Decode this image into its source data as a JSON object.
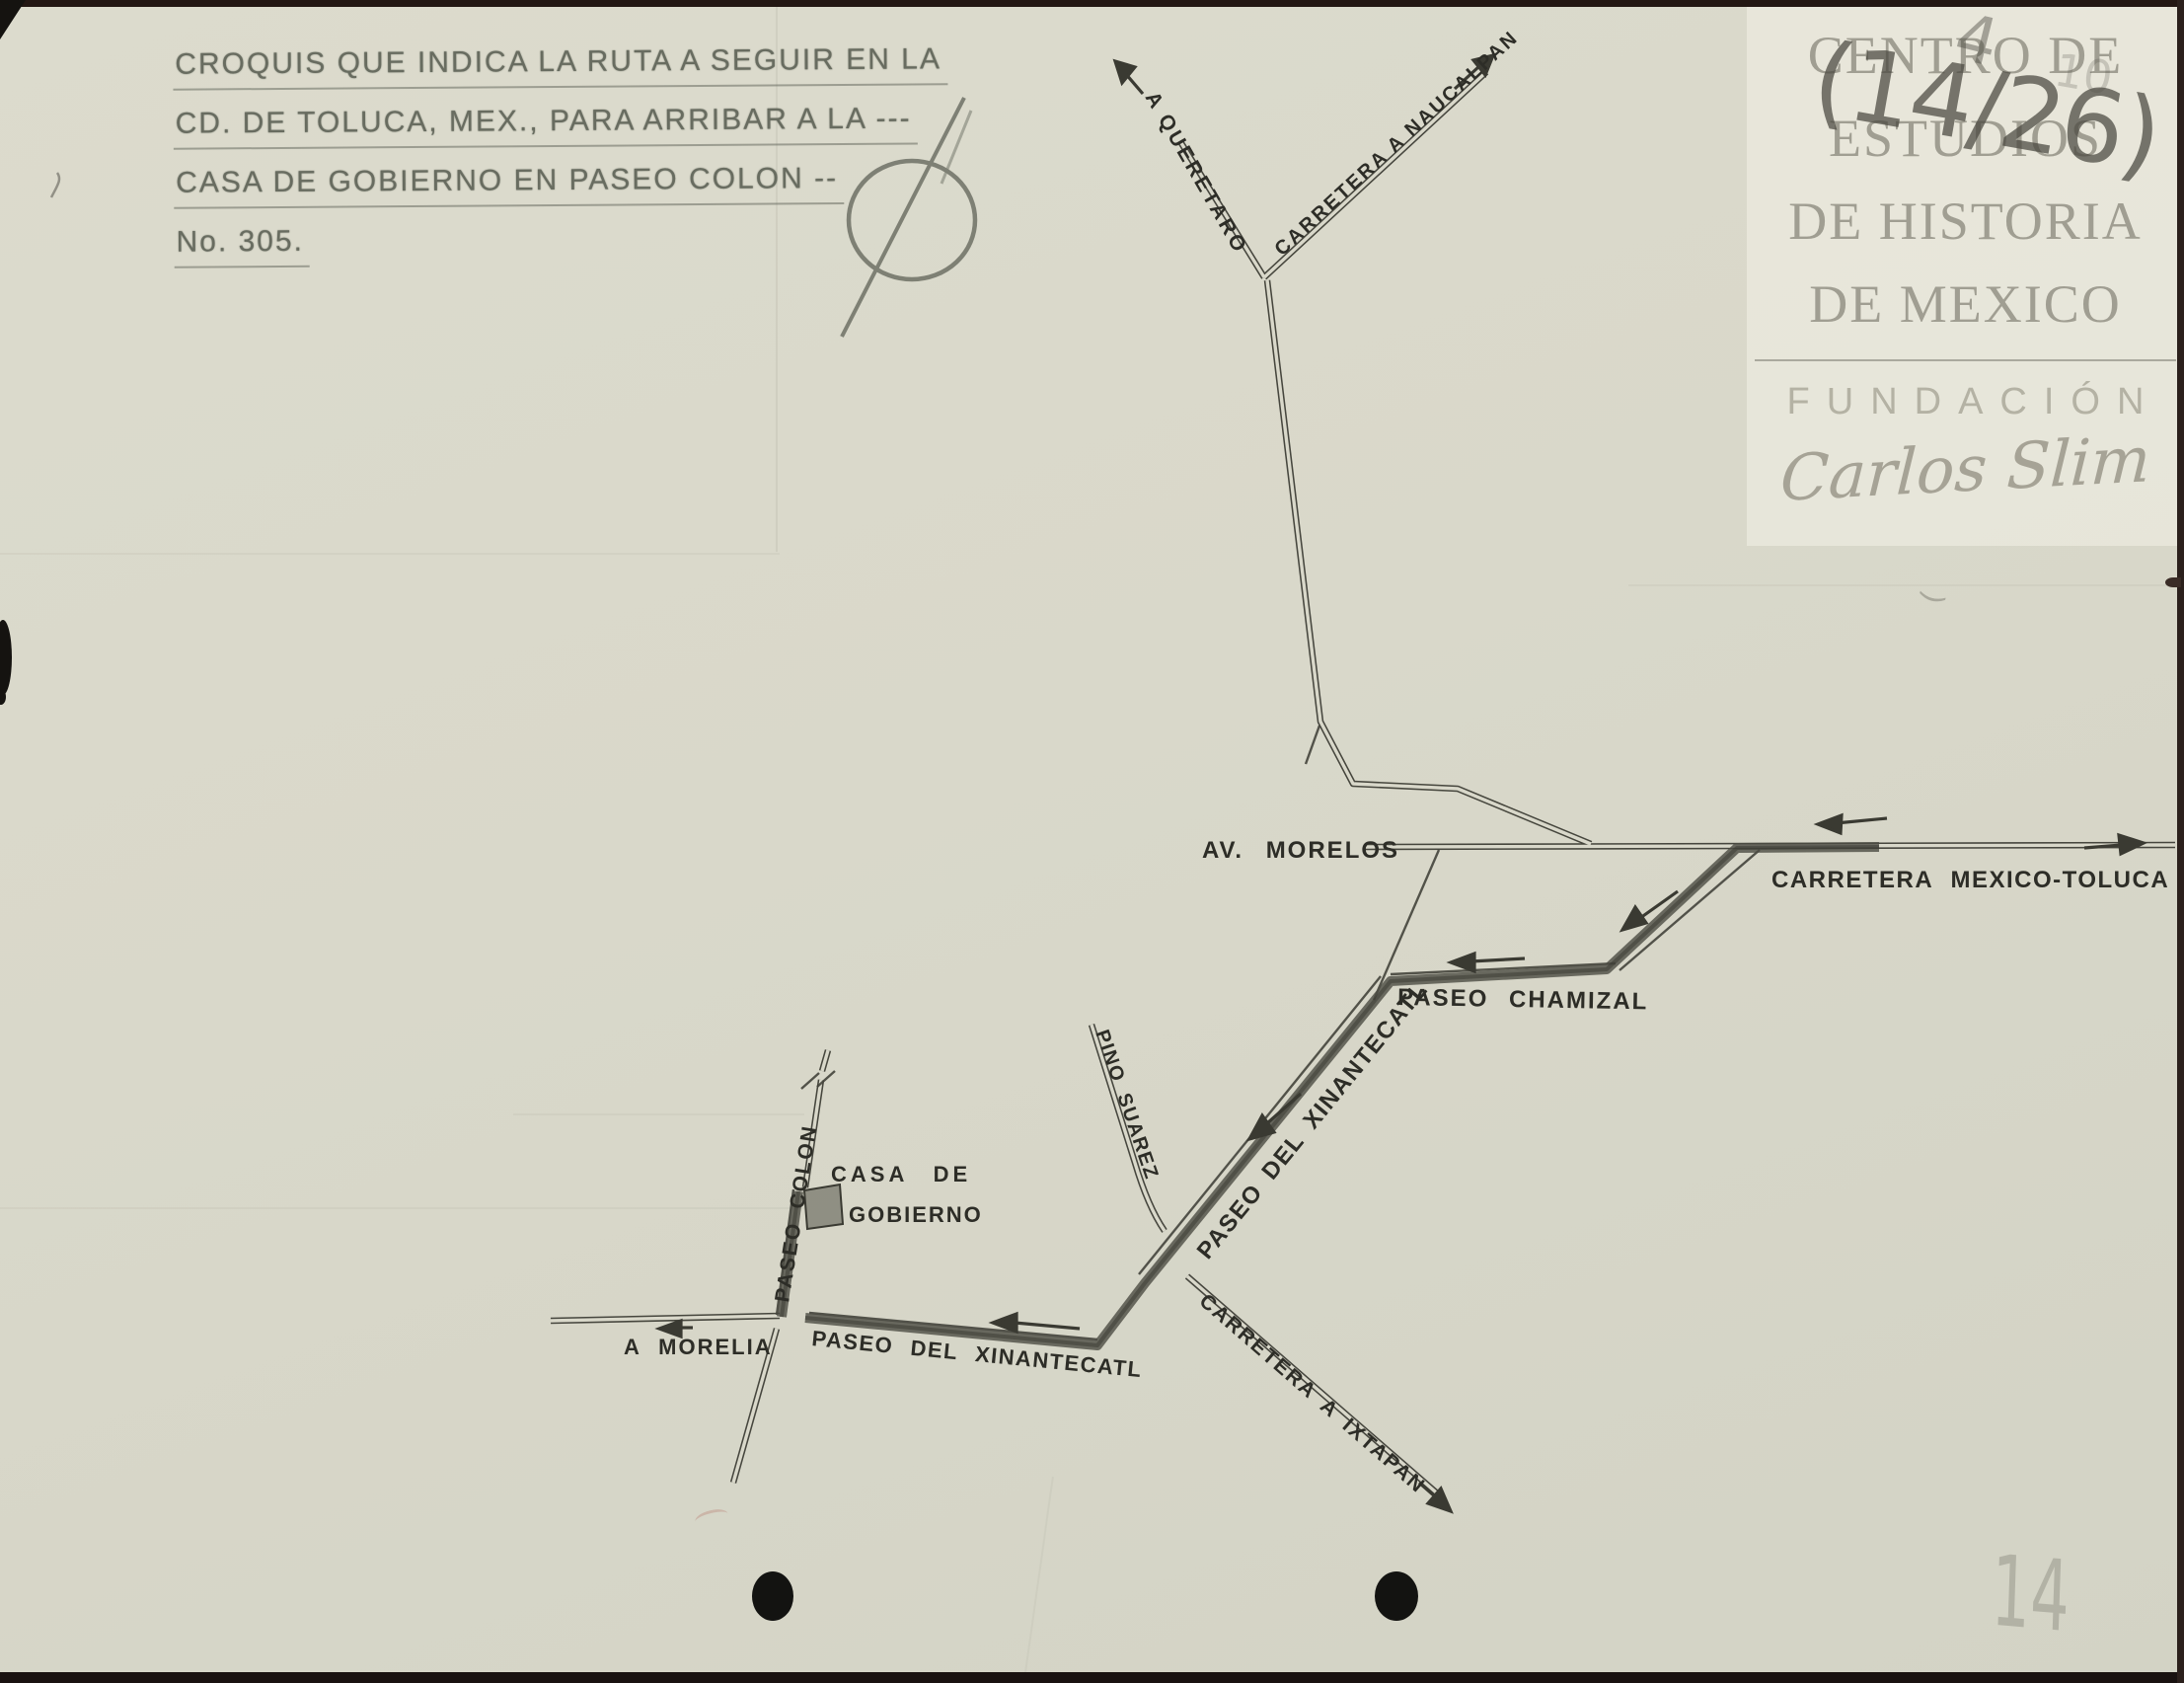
{
  "document": {
    "title_lines": [
      "CROQUIS QUE INDICA LA RUTA A SEGUIR EN LA",
      "CD. DE TOLUCA, MEX., PARA ARRIBAR A LA ---",
      "CASA DE GOBIERNO EN PASEO COLON --",
      "No. 305."
    ]
  },
  "watermark": {
    "lines": [
      "CENTRO DE",
      "ESTUDIOS",
      "DE HISTORIA",
      "DE MEXICO"
    ],
    "foundation": "FUNDACIÓN",
    "signature": "Carlos Slim"
  },
  "annotations": {
    "top_right_main": "(14/26)",
    "top_right_digit": "4",
    "top_right_faint": "10",
    "bottom_right": "14",
    "small_curl": ")"
  },
  "map": {
    "labels": {
      "a_queretaro": "A QUERETARO",
      "carretera_naucalpan": "CARRETERA A NAUCALPAN",
      "av_morelos": "AV. MORELOS",
      "carretera_mexico_toluca": "CARRETERA MEXICO-TOLUCA",
      "paseo_chamizal": "PASEO CHAMIZAL",
      "pino_suarez": "PINO SUAREZ",
      "paseo_xinantecatl_diag": "PASEO DEL XINANTECATL",
      "paseo_xinantecatl_bottom": "PASEO DEL XINANTECATL",
      "carretera_ixtapan": "CARRETERA A IXTAPAN",
      "a_morelia": "A MORELIA",
      "casa_de": "CASA DE",
      "gobierno": "GOBIERNO",
      "paseo_colon": "PASEO COLON"
    },
    "destination": "CASA DE GOBIERNO"
  },
  "colors": {
    "paper": "#d9d8ca",
    "map_ink": "#33332c",
    "route_ink": "#4c4c43",
    "stamp_ink": "#6b6f63",
    "watermark_text": "#a9a69a",
    "pencil": "#51504a"
  }
}
